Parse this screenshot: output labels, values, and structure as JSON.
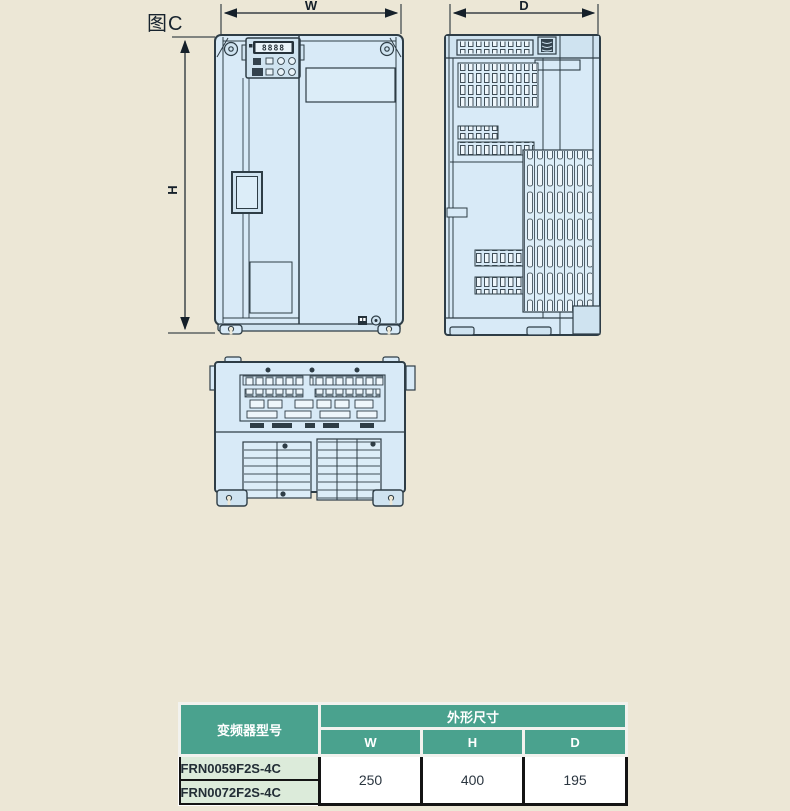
{
  "figure_label": "图C",
  "dimension_labels": {
    "w": "W",
    "h": "H",
    "d": "D"
  },
  "keypad_display": "8888",
  "colors": {
    "page_bg": "#ece7d6",
    "device_fill": "#d8eaf7",
    "device_light": "#cfe3f0",
    "line": "#2e3d46",
    "table_header_bg": "#4aa28e",
    "table_header_text": "#ffffff",
    "model_row_bg": "#dcebda",
    "value_cell_bg": "#ffffff"
  },
  "table": {
    "model_header": "变频器型号",
    "size_header": "外形尺寸",
    "columns": [
      "W",
      "H",
      "D"
    ],
    "models": [
      "FRN0059F2S-4C",
      "FRN0072F2S-4C"
    ],
    "values": {
      "W": "250",
      "H": "400",
      "D": "195"
    }
  }
}
